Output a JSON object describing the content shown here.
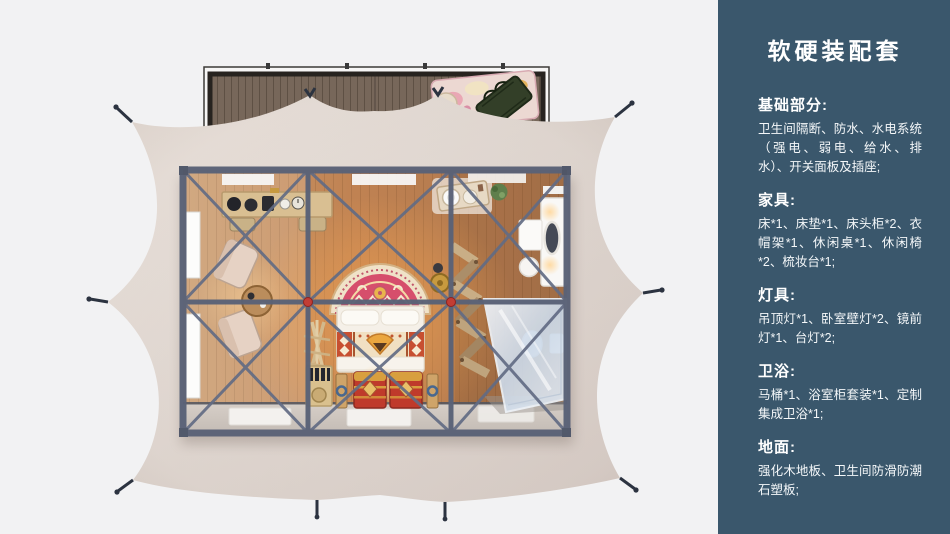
{
  "sidebar": {
    "title": "软硬装配套",
    "bg_color": "#3a576c",
    "text_color": "#ffffff",
    "sections": [
      {
        "heading": "基础部分:",
        "body": "卫生间隔断、防水、水电系统（强电、弱电、给水、排水）、开关面板及插座;"
      },
      {
        "heading": "家具:",
        "body": "床*1、床垫*1、床头柜*2、衣帽架*1、休闲桌*1、休闲椅*2、梳妆台*1;"
      },
      {
        "heading": "灯具:",
        "body": "吊顶灯*1、卧室壁灯*2、镜前灯*1、台灯*2;"
      },
      {
        "heading": "卫浴:",
        "body": "马桶*1、浴室柜套装*1、定制集成卫浴*1;"
      },
      {
        "heading": "地面:",
        "body": "强化木地板、卫生间防滑防潮石塑板;"
      }
    ]
  },
  "floorplan": {
    "type": "top-down-glamping-tent-render",
    "colors": {
      "background": "#f2f2f3",
      "tent_canvas": "#ddd3cc",
      "steel_frame": "#5a6277",
      "joint_node_red": "#c23b34",
      "wood_floor": "#c08252",
      "deck_wood": "#77675a",
      "bed_rug_red": "#d64e6c",
      "chest_red": "#bf3a2b",
      "shower_glass": "#dde7f1"
    },
    "items": [
      "wood-deck",
      "outdoor-rug",
      "storage-bench",
      "tent-canvas",
      "anchor-stakes",
      "steel-frame",
      "red-joint-nodes",
      "console-desk",
      "desk-chairs",
      "lounge-chair",
      "lounge-chair",
      "round-side-table",
      "bed",
      "arched-headboard-rug",
      "pillows",
      "kilim-blanket",
      "decorated-chest",
      "decorated-chest",
      "coat-rack",
      "bottle-rack",
      "washstand",
      "potted-plant",
      "dressing-table",
      "oval-mirror",
      "stool",
      "folding-screen",
      "glass-shower",
      "toilet",
      "floor-mats",
      "side-windows",
      "ceiling-light-panels",
      "brass-drum-table"
    ]
  }
}
